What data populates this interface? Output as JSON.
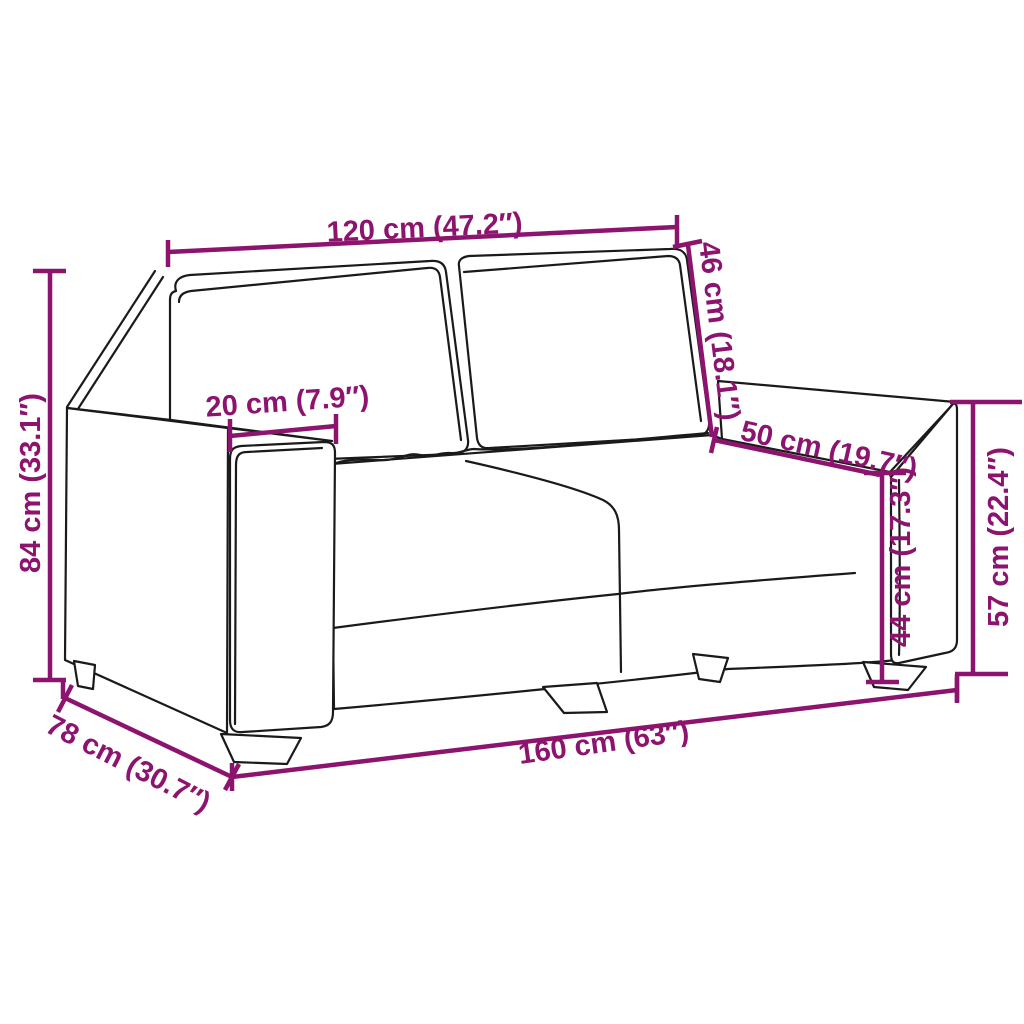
{
  "illustration": "two-seater sofa outline line drawing with dimension arrows",
  "colors": {
    "background": "#ffffff",
    "line_art": "#1a1a1a",
    "dimension": "#8C136E"
  },
  "dimensions": {
    "back_width": {
      "label": "120 cm (47.2″)",
      "cm": 120,
      "inches": 47.2
    },
    "back_height": {
      "label": "46 cm (18.1″)",
      "cm": 46,
      "inches": 18.1
    },
    "armrest_width": {
      "label": "20 cm (7.9″)",
      "cm": 20,
      "inches": 7.9
    },
    "seat_depth": {
      "label": "50 cm (19.7″)",
      "cm": 50,
      "inches": 19.7
    },
    "overall_height": {
      "label": "84 cm (33.1″)",
      "cm": 84,
      "inches": 33.1
    },
    "seat_height": {
      "label": "44 cm (17.3″)",
      "cm": 44,
      "inches": 17.3
    },
    "armrest_height": {
      "label": "57 cm (22.4″)",
      "cm": 57,
      "inches": 22.4
    },
    "overall_width": {
      "label": "160 cm (63″)",
      "cm": 160,
      "inches": 63
    },
    "overall_depth": {
      "label": "78 cm (30.7″)",
      "cm": 78,
      "inches": 30.7
    }
  }
}
